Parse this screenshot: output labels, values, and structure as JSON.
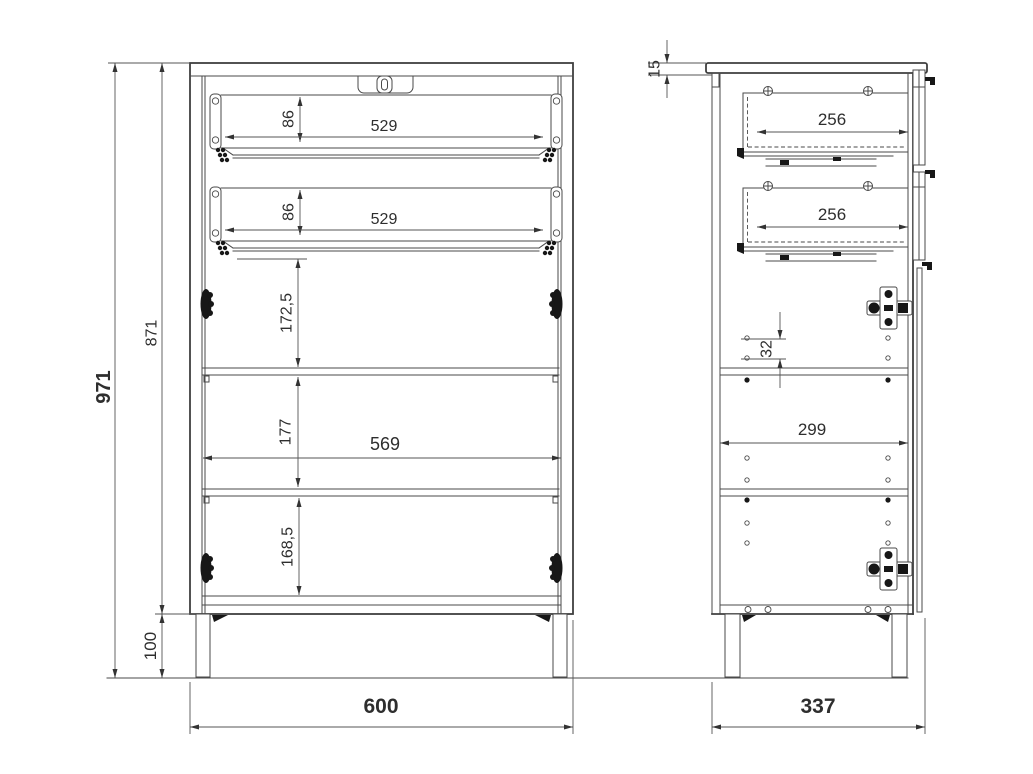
{
  "drawing": {
    "front_view": {
      "overall_height": "971",
      "carcass_height": "871",
      "leg_height": "100",
      "overall_width": "600",
      "drawer1_front_height": "86",
      "drawer1_width": "529",
      "drawer2_front_height": "86",
      "drawer2_width": "529",
      "upper_compartment_height": "172,5",
      "middle_compartment_height": "177",
      "interior_width": "569",
      "lower_compartment_height": "168,5"
    },
    "side_view": {
      "top_panel_thickness": "15",
      "drawer1_depth": "256",
      "drawer2_depth": "256",
      "shelf_hole_pitch": "32",
      "interior_depth": "299",
      "overall_depth": "337"
    }
  }
}
